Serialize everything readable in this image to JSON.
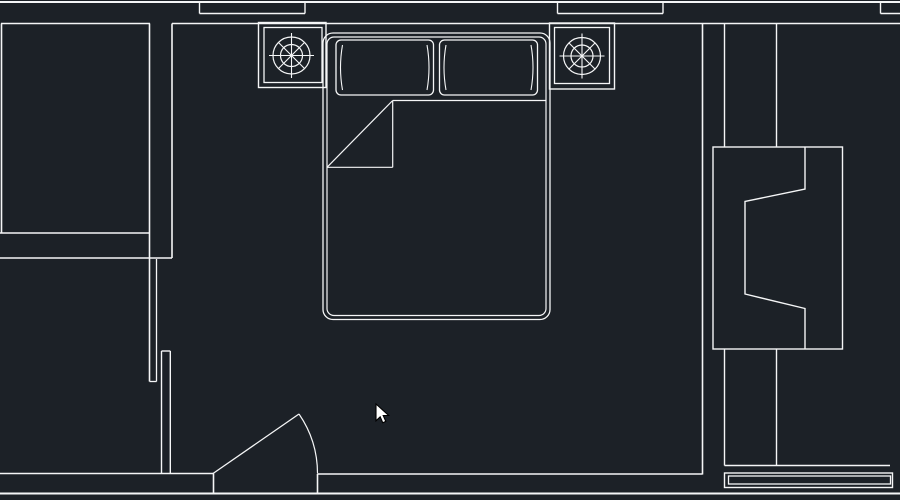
{
  "canvas": {
    "width": 900,
    "height": 500,
    "background": "#1c2127",
    "description": "CAD floor plan view of a bedroom, dark theme, white vector linework, mouse cursor visible"
  },
  "plan": {
    "line_color": "#f5f6f7",
    "default_stroke": 1.4,
    "elements": [
      {
        "name": "wall-top-outer",
        "type": "line",
        "pts": [
          0,
          2,
          900,
          2
        ],
        "w": 2
      },
      {
        "name": "wall-top-inner-left",
        "type": "line",
        "pts": [
          1,
          23.5,
          150,
          23.5
        ],
        "w": 1.6
      },
      {
        "name": "wall-top-inner-right",
        "type": "line",
        "pts": [
          172,
          23.5,
          900,
          23.5
        ],
        "w": 1.6
      },
      {
        "name": "window-a-sill",
        "type": "line",
        "pts": [
          199.5,
          13.5,
          305,
          13.5
        ],
        "w": 1.4
      },
      {
        "name": "window-a-jamb-left",
        "type": "line",
        "pts": [
          199.5,
          2,
          199.5,
          13.5
        ],
        "w": 1.4
      },
      {
        "name": "window-a-jamb-right",
        "type": "line",
        "pts": [
          305,
          2,
          305,
          13.5
        ],
        "w": 1.4
      },
      {
        "name": "window-b-sill",
        "type": "line",
        "pts": [
          557.5,
          13.5,
          663,
          13.5
        ],
        "w": 1.4
      },
      {
        "name": "window-b-jamb-left",
        "type": "line",
        "pts": [
          557.5,
          2,
          557.5,
          13.5
        ],
        "w": 1.4
      },
      {
        "name": "window-b-jamb-right",
        "type": "line",
        "pts": [
          663,
          2,
          663,
          13.5
        ],
        "w": 1.4
      },
      {
        "name": "window-c-sill",
        "type": "line",
        "pts": [
          880.5,
          13.5,
          900,
          13.5
        ],
        "w": 1.4
      },
      {
        "name": "window-c-jamb",
        "type": "line",
        "pts": [
          880.5,
          2,
          880.5,
          13.5
        ],
        "w": 1.4
      },
      {
        "name": "closet-left-edge",
        "type": "line",
        "pts": [
          1.5,
          23.5,
          1.5,
          233
        ],
        "w": 1.6
      },
      {
        "name": "closet-bottom-inner",
        "type": "line",
        "pts": [
          0,
          233,
          150,
          233
        ],
        "w": 1.6
      },
      {
        "name": "closet-bottom-outer",
        "type": "line",
        "pts": [
          0,
          258,
          172,
          258
        ],
        "w": 1.6
      },
      {
        "name": "left-wall-outer-face",
        "type": "line",
        "pts": [
          149.5,
          23.5,
          149.5,
          381.5
        ],
        "w": 1.6
      },
      {
        "name": "left-wall-lining",
        "type": "line",
        "pts": [
          156.5,
          259,
          156.5,
          381.5
        ],
        "w": 1.3
      },
      {
        "name": "left-wall-end-cap",
        "type": "line",
        "pts": [
          149.5,
          381.5,
          156.5,
          381.5
        ],
        "w": 1.3
      },
      {
        "name": "left-wall-inner-face",
        "type": "line",
        "pts": [
          172,
          23.5,
          172,
          258
        ],
        "w": 1.6
      },
      {
        "name": "lower-left-wall-left",
        "type": "line",
        "pts": [
          161.5,
          351,
          161.5,
          473.5
        ],
        "w": 1.4
      },
      {
        "name": "lower-left-wall-right",
        "type": "line",
        "pts": [
          170.3,
          351,
          170.3,
          473.5
        ],
        "w": 1.4
      },
      {
        "name": "lower-left-wall-cap",
        "type": "line",
        "pts": [
          161.5,
          351,
          170.3,
          351
        ],
        "w": 1.4
      },
      {
        "name": "bottom-wall-inner-left",
        "type": "line",
        "pts": [
          0,
          473.5,
          213.5,
          473.5
        ],
        "w": 1.6
      },
      {
        "name": "door-jamb-left",
        "type": "line",
        "pts": [
          213.5,
          473.5,
          213.5,
          493.5
        ],
        "w": 1.6
      },
      {
        "name": "bottom-wall-inner-right",
        "type": "line",
        "pts": [
          317.5,
          474,
          702.5,
          474
        ],
        "w": 1.6
      },
      {
        "name": "door-jamb-right",
        "type": "line",
        "pts": [
          317.5,
          474,
          317.5,
          493.5
        ],
        "w": 1.6
      },
      {
        "name": "bottom-wall-outer",
        "type": "line",
        "pts": [
          0,
          493.5,
          900,
          493.5
        ],
        "w": 2
      },
      {
        "name": "right-wall",
        "type": "line",
        "pts": [
          702.5,
          23.5,
          702.5,
          474.5
        ],
        "w": 1.6
      },
      {
        "name": "door-leaf",
        "type": "line",
        "pts": [
          213,
          473.5,
          299,
          414
        ],
        "w": 1.3
      },
      {
        "name": "door-swing-arc",
        "type": "path",
        "d": "M 299 414 A 105 105 0 0 1 317.5 473.5",
        "w": 1.2
      },
      {
        "name": "partition-left-upper",
        "type": "line",
        "pts": [
          724.5,
          23.5,
          724.5,
          147
        ],
        "w": 1.4
      },
      {
        "name": "partition-left-lower",
        "type": "line",
        "pts": [
          724.5,
          349,
          724.5,
          465.5
        ],
        "w": 1.4
      },
      {
        "name": "partition-right-upper",
        "type": "line",
        "pts": [
          776.5,
          23.5,
          776.5,
          147
        ],
        "w": 1.4
      },
      {
        "name": "partition-right-lower",
        "type": "line",
        "pts": [
          776.5,
          349,
          776.5,
          465.5
        ],
        "w": 1.4
      },
      {
        "name": "right-sill-line",
        "type": "line",
        "pts": [
          724.5,
          465.5,
          890,
          465.5
        ],
        "w": 1.4
      },
      {
        "name": "right-threshold-outer",
        "type": "rect",
        "pts": [
          724.5,
          473,
          168,
          14.5
        ],
        "w": 1.4
      },
      {
        "name": "right-threshold-inner",
        "type": "rect",
        "pts": [
          728.5,
          476,
          162,
          8
        ],
        "w": 1.3
      },
      {
        "name": "armchair-outline",
        "type": "rect",
        "pts": [
          713,
          147,
          129.5,
          202
        ],
        "w": 1.4
      },
      {
        "name": "armchair-back",
        "type": "polyline",
        "pts": [
          805,
          147,
          805,
          189,
          745,
          201.5,
          745,
          294,
          805,
          308.5,
          805,
          349
        ],
        "w": 1.4
      },
      {
        "name": "nightstand-left-outer",
        "type": "rect",
        "pts": [
          258.5,
          22.5,
          67.5,
          65
        ],
        "w": 1.4
      },
      {
        "name": "nightstand-left-inner",
        "type": "rect",
        "pts": [
          264,
          27.5,
          58,
          55
        ],
        "w": 1.3
      },
      {
        "name": "lamp-left-outer-circle",
        "type": "circle",
        "pts": [
          291.5,
          55.5,
          18.5
        ],
        "w": 1.2
      },
      {
        "name": "lamp-left-inner-circle",
        "type": "circle",
        "pts": [
          291.5,
          55.5,
          11
        ],
        "w": 1.2
      },
      {
        "name": "lamp-left-spoke-h",
        "type": "line",
        "pts": [
          269,
          55.5,
          314,
          55.5
        ],
        "w": 1.1
      },
      {
        "name": "lamp-left-spoke-v",
        "type": "line",
        "pts": [
          291.5,
          33,
          291.5,
          78
        ],
        "w": 1.1
      },
      {
        "name": "lamp-left-spoke-d1",
        "type": "line",
        "pts": [
          278.4,
          42.4,
          304.6,
          68.6
        ],
        "w": 1.1
      },
      {
        "name": "lamp-left-spoke-d2",
        "type": "line",
        "pts": [
          278.4,
          68.6,
          304.6,
          42.4
        ],
        "w": 1.1
      },
      {
        "name": "nightstand-right-outer",
        "type": "rect",
        "pts": [
          549.5,
          23,
          65,
          66
        ],
        "w": 1.4
      },
      {
        "name": "nightstand-right-inner",
        "type": "rect",
        "pts": [
          554.5,
          27.5,
          55,
          56
        ],
        "w": 1.3
      },
      {
        "name": "lamp-right-outer-circle",
        "type": "circle",
        "pts": [
          582,
          56,
          18.5
        ],
        "w": 1.2
      },
      {
        "name": "lamp-right-inner-circle",
        "type": "circle",
        "pts": [
          582,
          56,
          11
        ],
        "w": 1.2
      },
      {
        "name": "lamp-right-spoke-h",
        "type": "line",
        "pts": [
          559.5,
          56,
          604.5,
          56
        ],
        "w": 1.1
      },
      {
        "name": "lamp-right-spoke-v",
        "type": "line",
        "pts": [
          582,
          33.5,
          582,
          78.5
        ],
        "w": 1.1
      },
      {
        "name": "lamp-right-spoke-d1",
        "type": "line",
        "pts": [
          568.9,
          42.9,
          595.1,
          69.1
        ],
        "w": 1.1
      },
      {
        "name": "lamp-right-spoke-d2",
        "type": "line",
        "pts": [
          568.9,
          69.1,
          595.1,
          42.9
        ],
        "w": 1.1
      },
      {
        "name": "bed-outer",
        "type": "rect",
        "pts": [
          323,
          33,
          227,
          286.5
        ],
        "rx": 10,
        "w": 1.3
      },
      {
        "name": "bed-inner",
        "type": "rect",
        "pts": [
          327,
          37,
          219,
          278.5
        ],
        "rx": 7,
        "w": 1.2
      },
      {
        "name": "pillow-left",
        "type": "rect",
        "pts": [
          336,
          40,
          97.5,
          55
        ],
        "rx": 5,
        "w": 1.3
      },
      {
        "name": "pillow-left-crease-a",
        "type": "path",
        "d": "M 342.5 45 Q 338.5 67.5 342.5 90",
        "w": 1.1
      },
      {
        "name": "pillow-left-crease-b",
        "type": "path",
        "d": "M 427 45 Q 431 67.5 427 90",
        "w": 1.1
      },
      {
        "name": "pillow-right",
        "type": "rect",
        "pts": [
          439.5,
          40,
          98,
          55
        ],
        "rx": 5,
        "w": 1.3
      },
      {
        "name": "pillow-right-crease-a",
        "type": "path",
        "d": "M 446 45 Q 442 67.5 446 90",
        "w": 1.1
      },
      {
        "name": "pillow-right-crease-b",
        "type": "path",
        "d": "M 531 45 Q 535 67.5 531 90",
        "w": 1.1
      },
      {
        "name": "blanket-edge",
        "type": "line",
        "pts": [
          392.7,
          100.5,
          546.5,
          100.5
        ],
        "w": 1.2
      },
      {
        "name": "blanket-fold-vertical",
        "type": "line",
        "pts": [
          392.7,
          100.5,
          392.7,
          167.3
        ],
        "w": 1.2
      },
      {
        "name": "blanket-fold-horizontal",
        "type": "line",
        "pts": [
          327,
          167.3,
          392.7,
          167.3
        ],
        "w": 1.2
      },
      {
        "name": "blanket-fold-diagonal",
        "type": "line",
        "pts": [
          327,
          167.3,
          392.7,
          100.5
        ],
        "w": 1.2
      },
      {
        "name": "mouse-cursor",
        "type": "polygon",
        "pts": [
          376,
          404,
          376,
          420.8,
          380.2,
          416.8,
          382.8,
          422.8,
          385.8,
          421.4,
          383.2,
          415.5,
          388.7,
          415.5
        ],
        "fill": "#ffffff",
        "stroke": "#000000",
        "w": 1.1
      }
    ]
  }
}
